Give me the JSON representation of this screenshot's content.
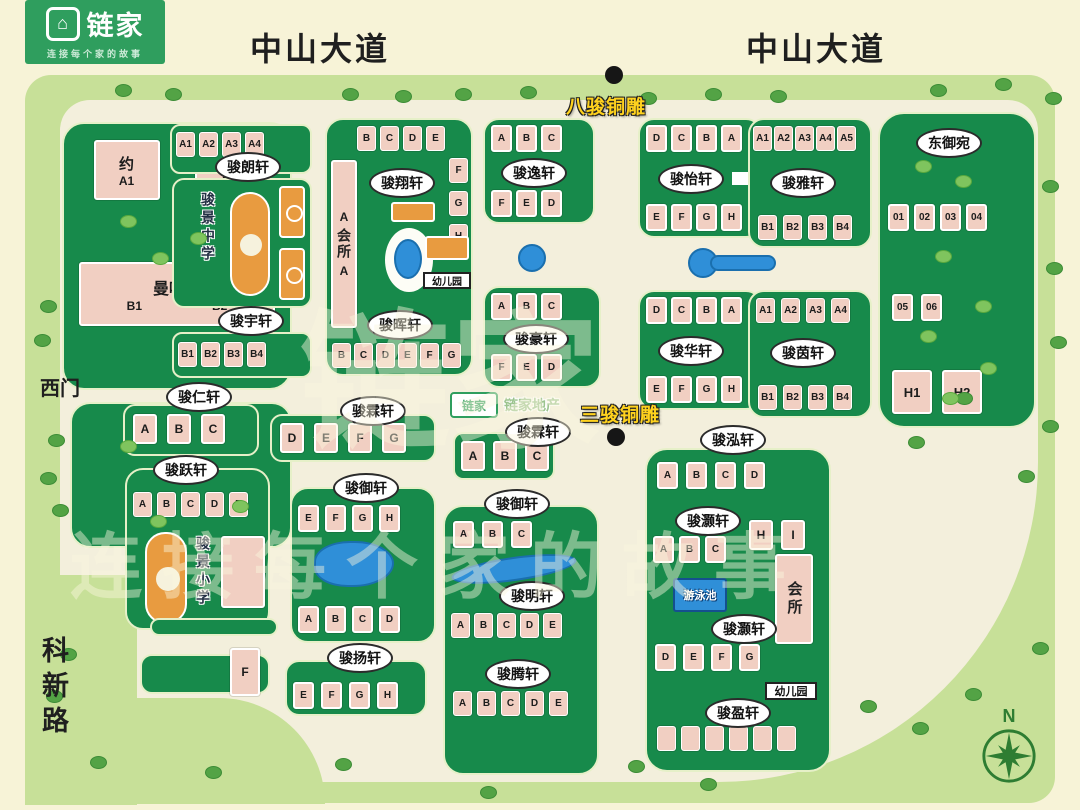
{
  "logo": {
    "brand": "链家",
    "tagline": "连接每个家的故事",
    "house_glyph": "⌂"
  },
  "roads": {
    "avenue_left": "中山大道",
    "avenue_right": "中山大道",
    "west_gate": "西门",
    "kexin_road": "科新路"
  },
  "landmarks": {
    "eight_horses": "八骏铜雕",
    "three_horses": "三骏铜雕",
    "compass_n": "N"
  },
  "map_badge": {
    "logo_text": "链家",
    "agency_text": "链家地产"
  },
  "watermark": {
    "big": "链家",
    "slogan": "连 接 每 个 家 的 故 事"
  },
  "facilities": {
    "middle_school": "骏景中学",
    "primary_school": "骏景小学",
    "clubhouse_west": "会所",
    "clubhouse_east": "会所",
    "kindergarten_west": "幼儿园",
    "kindergarten_east": "幼儿园",
    "pool": "游泳池"
  },
  "clusters": {
    "yorker": {
      "name_a": "约",
      "name_b": "克",
      "a1": "A1",
      "a2": "A2",
      "manhattan": "曼哈顿",
      "b1": "B1",
      "b2": "B2"
    },
    "junlang": {
      "label": "骏朗轩",
      "top": [
        "A1",
        "A2",
        "A3",
        "A4"
      ]
    },
    "junyu_n": {
      "label": "骏宇轩",
      "bottom": [
        "B1",
        "B2",
        "B3",
        "B4"
      ]
    },
    "junxiang": {
      "label": "骏翔轩",
      "top": [
        "B",
        "C",
        "D",
        "E"
      ],
      "right": [
        "F",
        "G",
        "H"
      ],
      "left_top": "A",
      "left_bottom": "A"
    },
    "junhui": {
      "label": "骏晖轩",
      "bottom": [
        "B",
        "C",
        "D",
        "E",
        "F",
        "G"
      ]
    },
    "junyi": {
      "label": "骏逸轩",
      "top": [
        "A",
        "B",
        "C"
      ],
      "bottom": [
        "F",
        "E",
        "D"
      ]
    },
    "junhao": {
      "label": "骏豪轩",
      "top": [
        "A",
        "B",
        "C"
      ],
      "bottom": [
        "F",
        "E",
        "D"
      ]
    },
    "junyi2": {
      "label": "骏怡轩",
      "top": [
        "D",
        "C",
        "B",
        "A"
      ],
      "bottom": [
        "E",
        "F",
        "G",
        "H"
      ]
    },
    "junhua": {
      "label": "骏华轩",
      "top": [
        "D",
        "C",
        "B",
        "A"
      ],
      "bottom": [
        "E",
        "F",
        "G",
        "H"
      ]
    },
    "junya": {
      "label": "骏雅轩",
      "top": [
        "A1",
        "A2",
        "A3",
        "A4",
        "A5"
      ],
      "bottom": [
        "B1",
        "B2",
        "B3",
        "B4"
      ]
    },
    "junyin": {
      "label": "骏茵轩",
      "top": [
        "A1",
        "A2",
        "A3",
        "A4"
      ],
      "bottom": [
        "B1",
        "B2",
        "B3",
        "B4"
      ]
    },
    "dongyuwan": {
      "label": "东御宛",
      "row1": [
        "01",
        "02",
        "03",
        "04"
      ],
      "row2": [
        "05",
        "06"
      ],
      "row3": [
        "H1",
        "H2"
      ]
    },
    "junren": {
      "label": "骏仁轩",
      "row": [
        "A",
        "B",
        "C"
      ]
    },
    "junlin_w": {
      "label": "骏霖轩",
      "row": [
        "D",
        "E",
        "F",
        "G"
      ]
    },
    "junlin_e": {
      "label": "骏霖轩",
      "row": [
        "A",
        "B",
        "C"
      ]
    },
    "junhong": {
      "label": "骏泓轩",
      "row": [
        "A",
        "B",
        "C",
        "D"
      ]
    },
    "junhao2_n": {
      "label": "骏灏轩",
      "row": [
        "A",
        "B",
        "C"
      ],
      "h": "H",
      "i": "I"
    },
    "junhao2_s": {
      "label": "骏灏轩",
      "row": [
        "D",
        "E",
        "F",
        "G"
      ]
    },
    "junying": {
      "label": "骏盈轩"
    },
    "junyue": {
      "label": "骏跃轩",
      "row": [
        "A",
        "B",
        "C",
        "D",
        "E"
      ]
    },
    "junyu_w": {
      "label": "骏御轩",
      "top": [
        "E",
        "F",
        "G",
        "H"
      ],
      "bottom": [
        "A",
        "B",
        "C",
        "D"
      ]
    },
    "junyang": {
      "label": "骏扬轩",
      "row": [
        "E",
        "F",
        "G",
        "H"
      ]
    },
    "junyu_e": {
      "label": "骏御轩",
      "row": [
        "A",
        "B",
        "C"
      ]
    },
    "junming": {
      "label": "骏明轩",
      "row": [
        "A",
        "B",
        "C",
        "D",
        "E"
      ]
    },
    "junteng": {
      "label": "骏腾轩",
      "row": [
        "A",
        "B",
        "C",
        "D",
        "E"
      ]
    },
    "strip": {
      "f": "F"
    }
  },
  "colors": {
    "brand_green": "#2f9e5e",
    "cluster_green": "#178a4b",
    "light_green": "#c7e098",
    "cream": "#f3efdc",
    "building_pink": "#f1cfc2",
    "water_blue": "#2f8fd8",
    "court_orange": "#e89b40",
    "landmark_yellow": "#ffd21e"
  }
}
